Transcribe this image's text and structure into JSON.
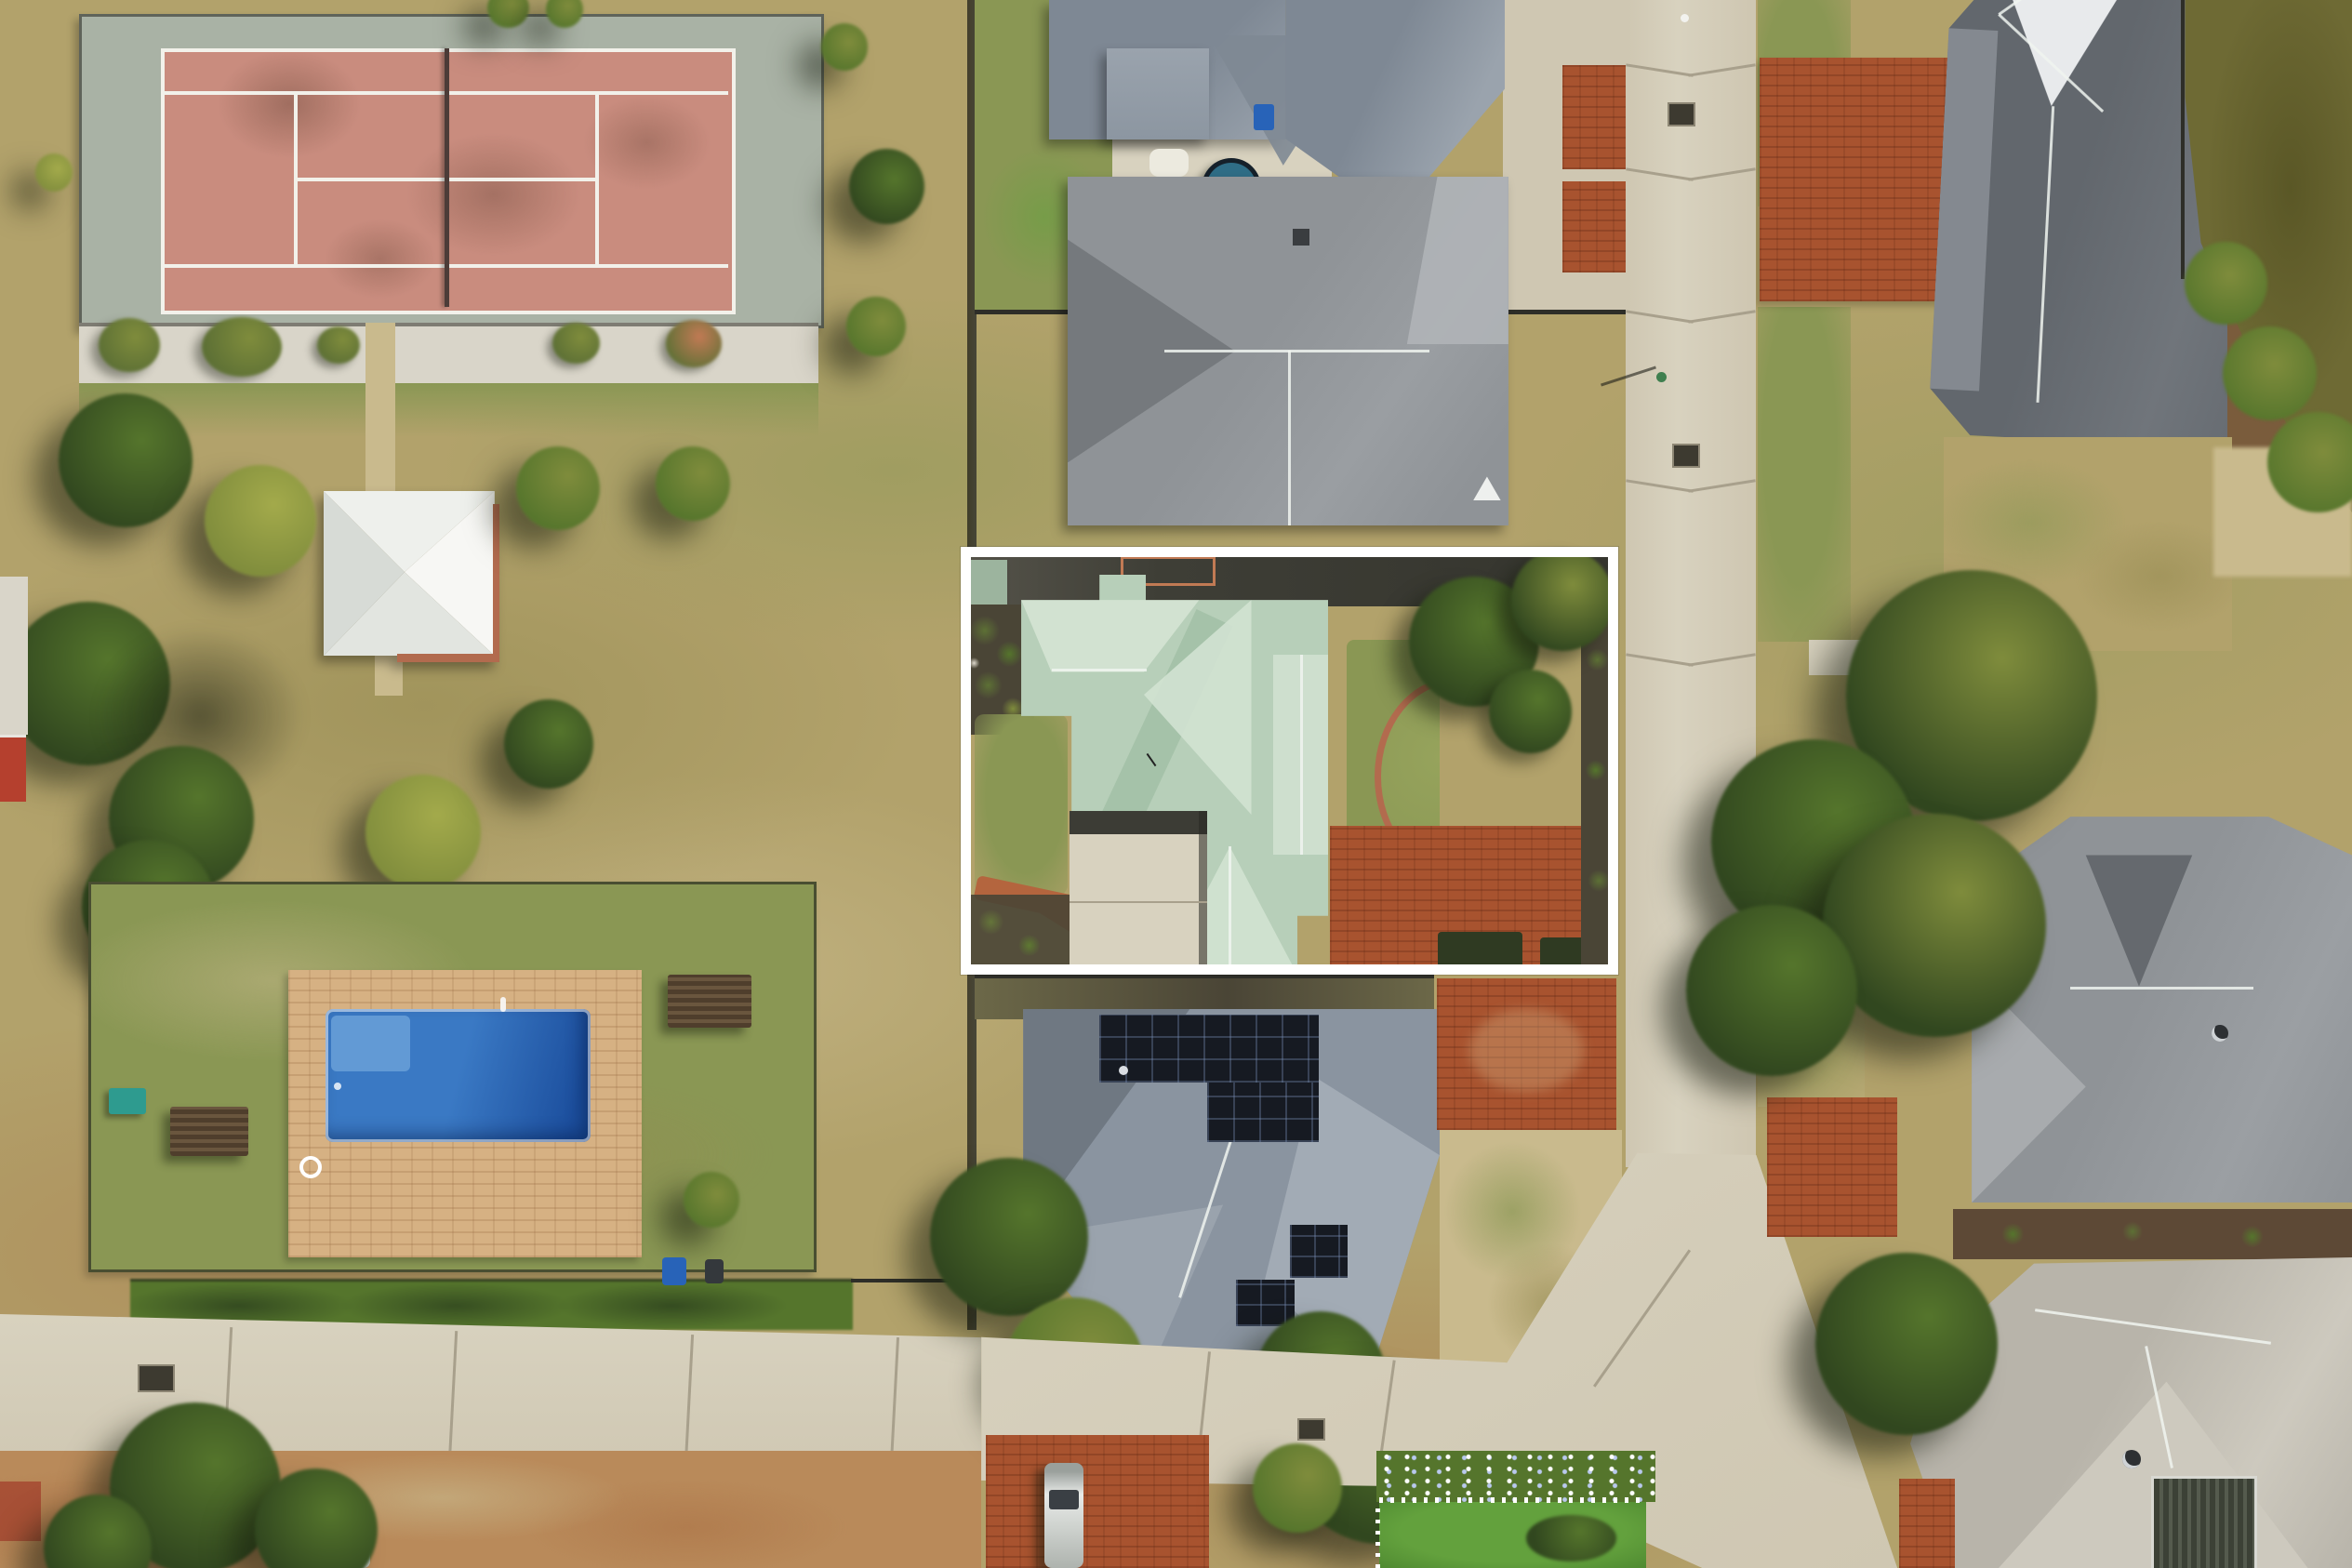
{
  "scene": {
    "description": "Aerial drone photograph of a suburban neighbourhood: public park with tennis court, gazebo and swimming pool on the left; rows of houses, concrete streets and a pond on the right; one property outlined with a thick white rectangle (mint-green roofed house).",
    "highlight": {
      "shape": "rectangle",
      "border_color": "#ffffff"
    },
    "regions": [
      {
        "name": "tennis-court",
        "type": "sports-court"
      },
      {
        "name": "park-gazebo",
        "type": "shelter"
      },
      {
        "name": "public-pool",
        "type": "swimming-pool"
      },
      {
        "name": "highlighted-property",
        "type": "house",
        "roof_color": "mint-green"
      },
      {
        "name": "top-house",
        "type": "house",
        "roof_color": "blue-gray"
      },
      {
        "name": "gray-roof-house",
        "type": "house",
        "roof_color": "gray"
      },
      {
        "name": "solar-panel-house",
        "type": "house",
        "roof_color": "blue-gray",
        "solar_panels": true
      },
      {
        "name": "top-right-house",
        "type": "house",
        "roof_color": "dark-gray"
      },
      {
        "name": "mid-right-house",
        "type": "house",
        "roof_color": "gray"
      },
      {
        "name": "bottom-right-house",
        "type": "house",
        "roof_color": "warm-gray"
      },
      {
        "name": "pond",
        "type": "water"
      },
      {
        "name": "vertical-street",
        "type": "road"
      },
      {
        "name": "bottom-street",
        "type": "road"
      }
    ]
  },
  "palette": {
    "dry_grass": "#b2a26b",
    "dry_grass_dark": "#93894f",
    "dry_grass_pale": "#c9ba8d",
    "lawn_green": "#8a9754",
    "lawn_bright": "#63a13d",
    "dirt": "#b98a5a",
    "dirt_red": "#a96f43",
    "court_red": "#c98c7e",
    "court_stain": "#9c7164",
    "court_apron": "#a9b2a5",
    "court_line": "#f2f1ea",
    "net_dark": "#4c3c38",
    "gravel": "#d9d5c9",
    "shrub_green": "#5d7035",
    "gazebo_white": "#f7f7f4",
    "gazebo_shade": "#d7dbd6",
    "brick_edge": "#b26b4e",
    "pool_blue": "#3a79c4",
    "pool_deep": "#1c4f9e",
    "pool_steps": "#6aa0d8",
    "paving_tan": "#d6b183",
    "wood_dark": "#4f3e2c",
    "fence_dark": "#2e2e28",
    "concrete": "#cfc7b2",
    "concrete_light": "#d8d2bf",
    "joint": "#a8a08c",
    "brick_drive": "#a8532f",
    "brick_light": "#c17a54",
    "roof_bluegray": "#7e8894",
    "roof_bluegray_light": "#9aa3ad",
    "roof_gray": "#8f9397",
    "roof_gray_light": "#b2b5b8",
    "roof_dark": "#62676d",
    "roof_glint": "#e8eaec",
    "roof_mint": "#b7cfb9",
    "roof_mint_light": "#d2e2d1",
    "roof_mint_dark": "#a2bfa6",
    "roof_warm": "#b8b4aa",
    "roof_warm_light": "#cdc9be",
    "solar": "#161a22",
    "pond": "#6e6a34",
    "pond_deep": "#5a5726",
    "tree_dark": "#31471f",
    "tree_green": "#55752c",
    "tree_olive": "#7f8c3c",
    "tree_yellow": "#a3aa4b",
    "soil": "#4a4536",
    "mulch": "#7a5c3c",
    "white": "#ffffff",
    "car_silver": "#d4d6d4"
  }
}
